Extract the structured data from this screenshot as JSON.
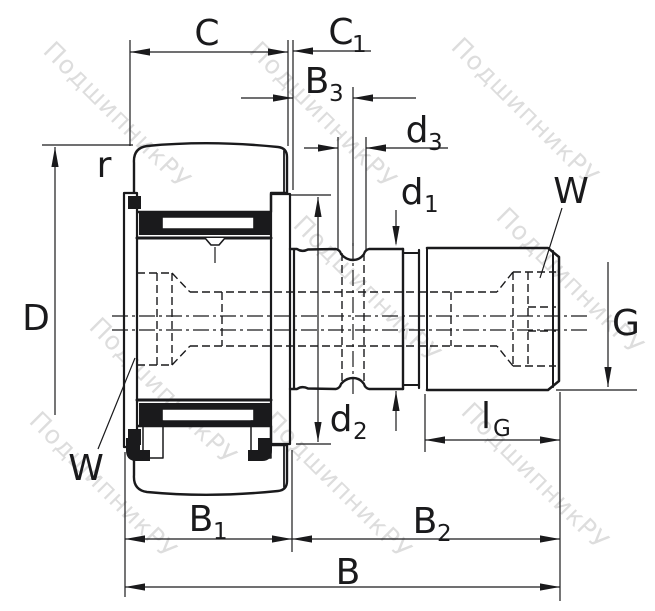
{
  "drawing": {
    "kind": "bearing-cross-section-diagram",
    "colors": {
      "line": "#1a1a1c",
      "background": "#ffffff",
      "watermark": "#bcbcbc"
    }
  },
  "watermark": {
    "text": "ПодшипникРУ"
  },
  "labels": {
    "C": {
      "base": "C",
      "sub": ""
    },
    "C1": {
      "base": "C",
      "sub": "1"
    },
    "B3": {
      "base": "B",
      "sub": "3"
    },
    "d3": {
      "base": "d",
      "sub": "3"
    },
    "d1": {
      "base": "d",
      "sub": "1"
    },
    "W_top": {
      "base": "W",
      "sub": ""
    },
    "r": {
      "base": "r",
      "sub": ""
    },
    "D": {
      "base": "D",
      "sub": ""
    },
    "G": {
      "base": "G",
      "sub": ""
    },
    "d2": {
      "base": "d",
      "sub": "2"
    },
    "lG": {
      "base": "l",
      "sub": "G"
    },
    "W_bottom": {
      "base": "W",
      "sub": ""
    },
    "B1": {
      "base": "B",
      "sub": "1"
    },
    "B2": {
      "base": "B",
      "sub": "2"
    },
    "B": {
      "base": "B",
      "sub": ""
    }
  }
}
